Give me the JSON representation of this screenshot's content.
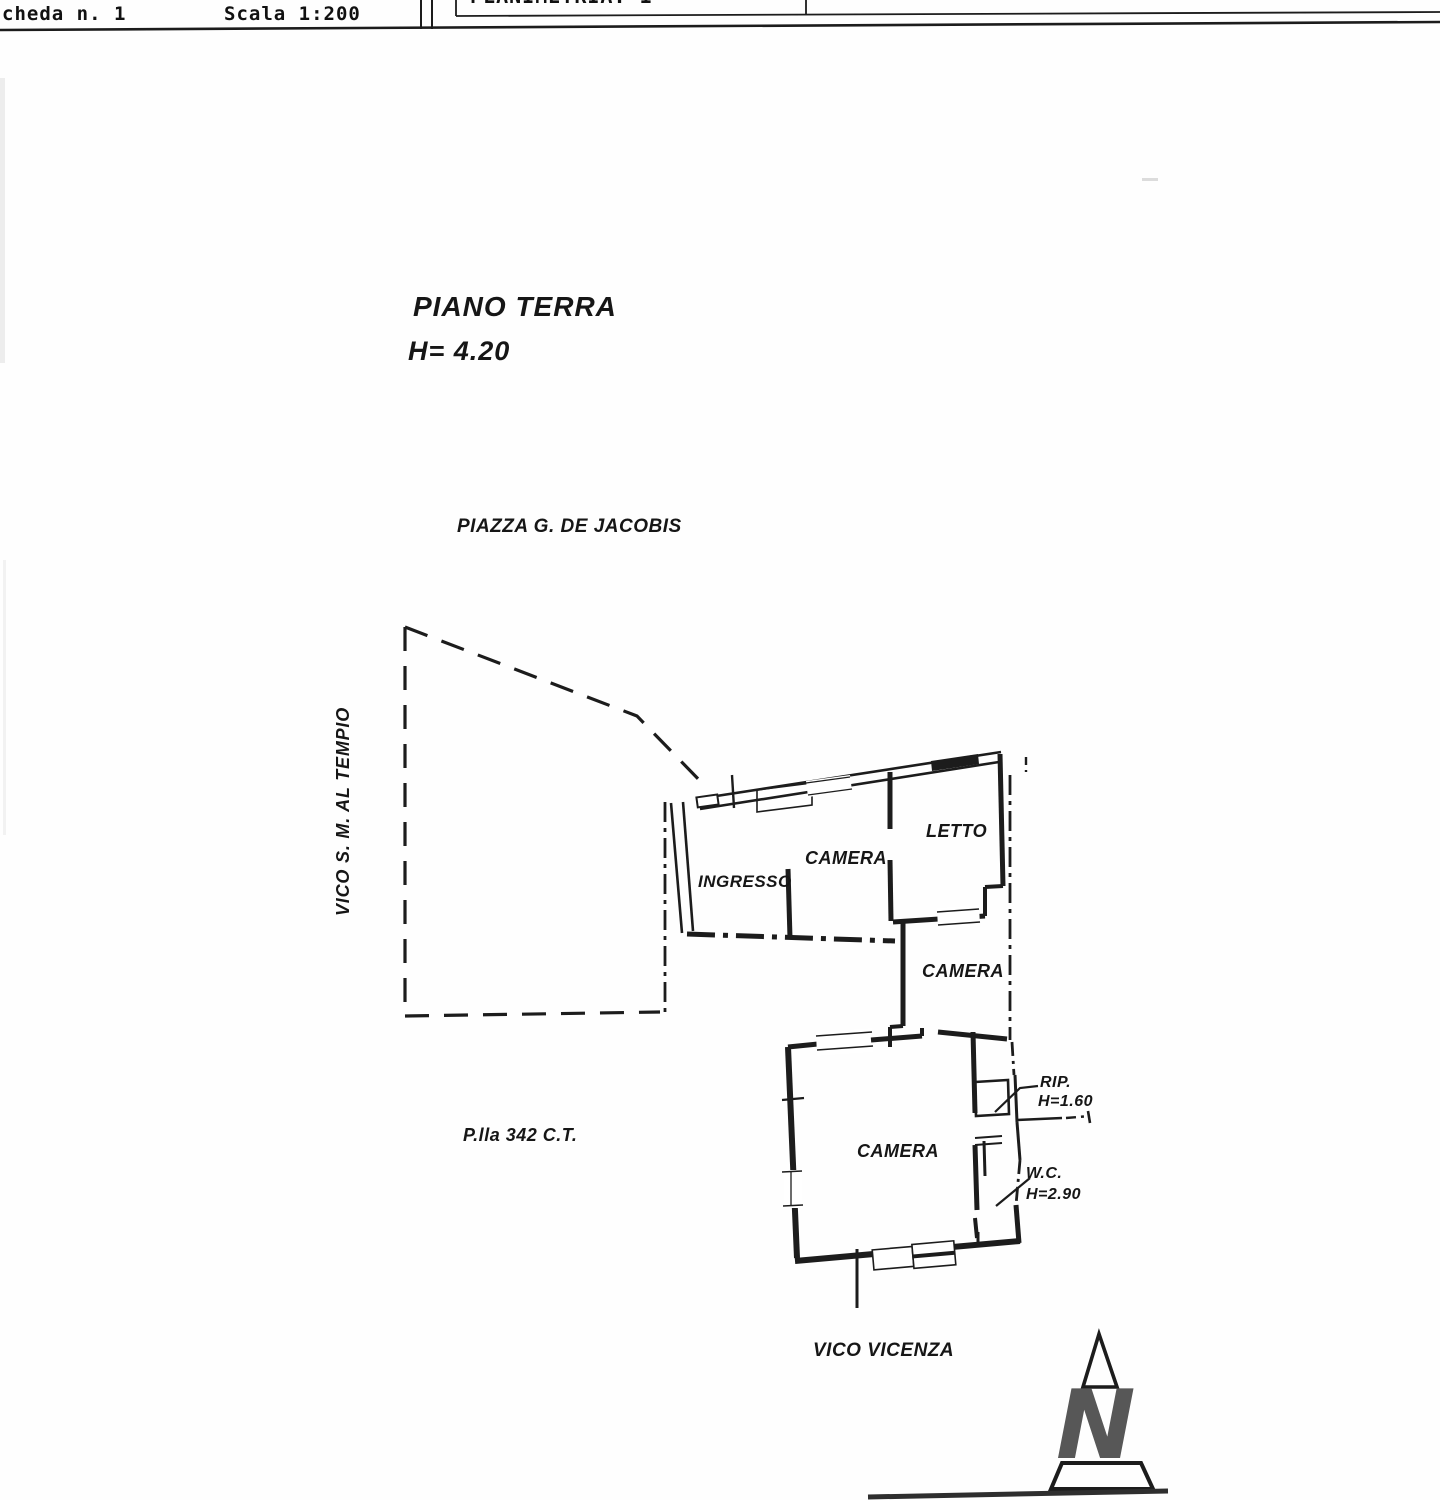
{
  "header": {
    "scheda": "cheda n. 1",
    "scala": "Scala 1:200",
    "planimetria": "PLANIMETRIA: 1"
  },
  "plan": {
    "floor_title": "PIANO TERRA",
    "floor_height": "H= 4.20",
    "street_top": "PIAZZA G. DE JACOBIS",
    "street_left": "VICO S. M. AL TEMPIO",
    "street_bottom": "VICO VICENZA",
    "parcel_label": "P.lla 342 C.T.",
    "rooms": {
      "ingresso": "INGRESSO",
      "camera_top": "CAMERA",
      "letto": "LETTO",
      "camera_mid": "CAMERA",
      "camera_main": "CAMERA",
      "rip": "RIP.",
      "rip_height": "H=1.60",
      "wc": "W.C.",
      "wc_height": "H=2.90"
    }
  },
  "north": {
    "letter": "N"
  },
  "colors": {
    "ink": "#1c1c1c",
    "north_letter": "#575757"
  }
}
